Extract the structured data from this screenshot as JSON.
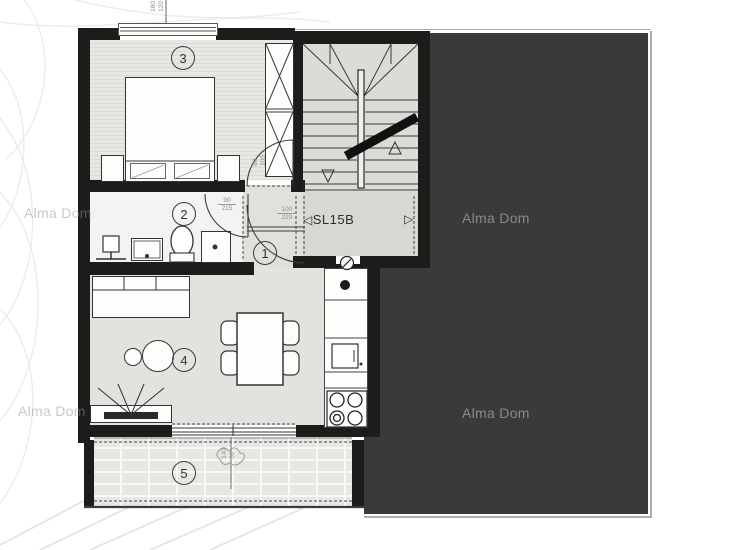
{
  "plan": {
    "unit": {
      "marker_left": "◁",
      "label": "SL15B",
      "marker_right": "▷"
    },
    "rooms": [
      {
        "number": "1"
      },
      {
        "number": "2"
      },
      {
        "number": "3"
      },
      {
        "number": "4"
      },
      {
        "number": "5"
      }
    ],
    "watermark": "Alma Dom",
    "dimensions": {
      "window": {
        "w": "180",
        "h": "120"
      },
      "bedroom_door": {
        "w": "80",
        "h": "205"
      },
      "bathroom_door": {
        "w": "90",
        "h": "215"
      },
      "entry_door": {
        "w": "100",
        "h": "220"
      },
      "balcony": {
        "a": "140",
        "b": "60"
      }
    },
    "colors": {
      "dark_area": "#3b3a38",
      "walls": "#1d1c1b",
      "floor_light": "#e3e2de",
      "watermark_on_dark": "#8a8988"
    }
  }
}
